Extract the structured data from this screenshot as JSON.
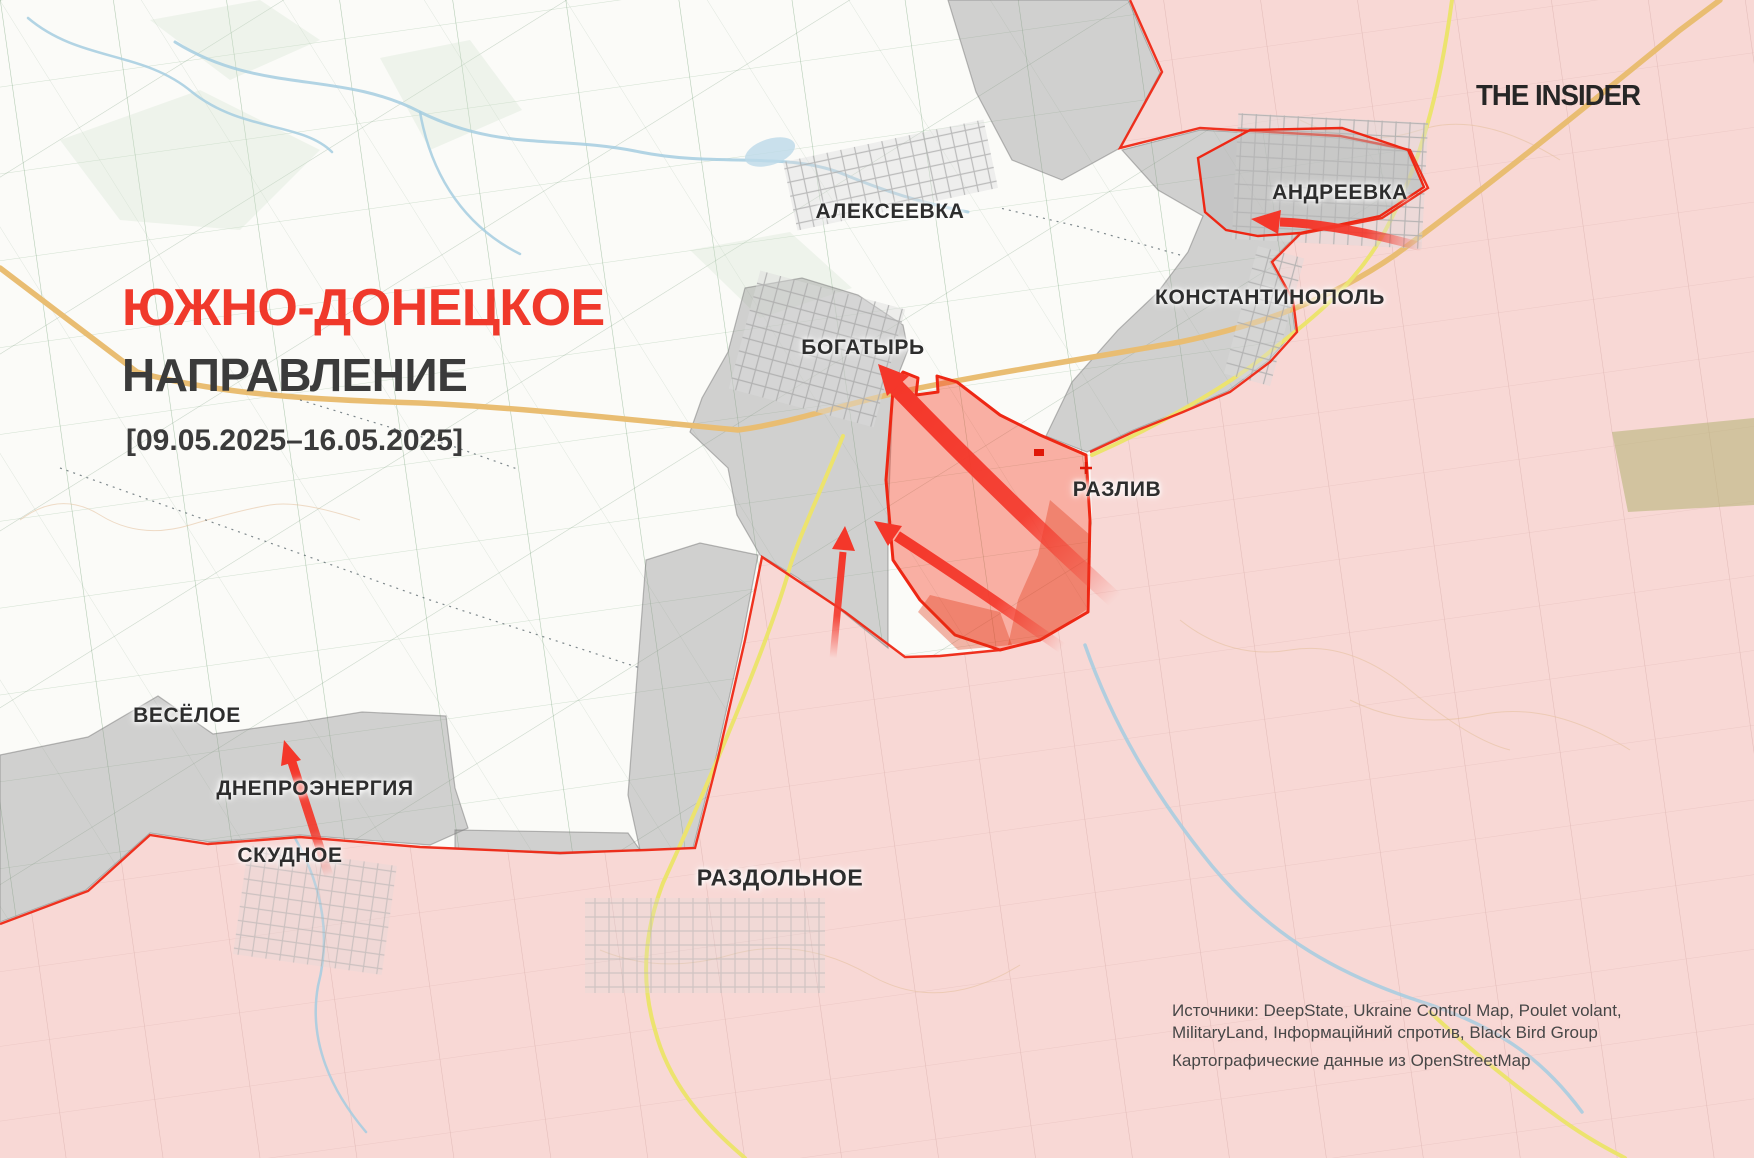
{
  "header": {
    "title_line1": "ЮЖНО-ДОНЕЦКОЕ",
    "title_line2": "НАПРАВЛЕНИЕ",
    "date_range": "[09.05.2025–16.05.2025]",
    "logo": "THE INSIDER"
  },
  "sources": {
    "line1": "Источники: DeepState, Ukraine Control Map, Poulet volant,",
    "line2": "MilitaryLand, Інформаційний спротив, Black Bird Group",
    "line3": "Картографические данные из OpenStreetMap"
  },
  "colors": {
    "title_red": "#f0392b",
    "arrow_red": "#f4372a",
    "advance_fill": "rgba(246,68,45,0.42)",
    "advance_stroke": "#ee2714",
    "occupied_pink": "#f8d8d5",
    "contested_gray": "rgba(145,145,145,0.40)",
    "road_orange": "#e9bd72",
    "road_yellow": "#ece36e",
    "river_blue": "#a5cde0",
    "field_green": "#6f9e72",
    "field_pink_line": "#d9aeaa",
    "contour_tan": "#e4c09b",
    "label_dark": "#2d2d2d"
  },
  "labels": [
    {
      "id": "alekseevka",
      "text": "АЛЕКСЕЕВКА",
      "x": 890,
      "y": 212
    },
    {
      "id": "andreevka",
      "text": "АНДРЕЕВКА",
      "x": 1340,
      "y": 193
    },
    {
      "id": "konstantinopol",
      "text": "КОНСТАНТИНОПОЛЬ",
      "x": 1270,
      "y": 298
    },
    {
      "id": "bogatyr",
      "text": "БОГАТЫРЬ",
      "x": 863,
      "y": 348
    },
    {
      "id": "razliv",
      "text": "РАЗЛИВ",
      "x": 1117,
      "y": 490
    },
    {
      "id": "vesyoloe",
      "text": "ВЕСЁЛОЕ",
      "x": 187,
      "y": 716
    },
    {
      "id": "dneproenergia",
      "text": "ДНЕПРОЭНЕРГИЯ",
      "x": 315,
      "y": 789
    },
    {
      "id": "skudnoe",
      "text": "СКУДНОЕ",
      "x": 290,
      "y": 856
    },
    {
      "id": "razdolnoe",
      "text": "РАЗДОЛЬНОЕ",
      "x": 780,
      "y": 878,
      "size": 23
    }
  ],
  "map": {
    "width": 1754,
    "height": 1158,
    "occupied_polygon": "1130,0 1754,0 1754,1158 0,1158 0,924 88,891 150,835 208,844 300,837 420,847 560,853 646,850 695,848 718,758 745,640 762,557 845,612 905,657 1000,650 1040,640 1089,612 1092,520 1090,452 1133,432 1183,412 1230,392 1270,362 1297,332 1293,300 1272,262 1300,234 1382,218 1428,188 1410,150 1340,136 1200,128 1120,148 1162,72",
    "frontline": "1130,0 1162,72 1120,148 1200,128 1340,136 1410,150 1428,188 1382,218 1300,234 1272,262 1293,300 1297,332 1270,362 1230,392 1183,412 1133,432 1090,452",
    "frontline_south": "1000,650 940,656 905,657 845,612 762,557 745,640 718,758 695,848 646,850 560,853 420,847 300,837 208,844 150,835 88,891 0,924",
    "gray_zones": [
      "948,0 1128,0 1160,73 1120,148 1062,180 1012,160 976,92",
      "1122,150 1200,130 1340,138 1406,150 1424,187 1380,217 1298,234 1270,262 1291,300 1295,331 1268,361 1228,391 1181,411 1131,431 1087,452 1046,436 1072,382 1118,330 1158,292 1188,252 1203,216 1158,190",
      "745,288 802,278 858,295 903,325 908,350 893,388 888,520 888,648 838,608 798,578 760,555 737,515 728,468 690,432 702,398 728,352",
      "0,755 88,737 158,696 213,734 300,722 362,712 446,716 455,788 468,828 430,845 300,835 210,842 150,833 86,890 0,922",
      "646,560 700,543 758,555 742,640 716,757 693,848 640,850 628,795 636,690",
      "455,830 628,833 640,850 560,854 455,848"
    ],
    "pocket_polygon": "1205,212 1198,158 1250,130 1342,128 1408,150 1424,187 1380,216 1300,233 1258,236 1226,230",
    "advance_polygon": "893,390 903,372 918,378 916,395 938,392 937,376 957,382 1000,415 1040,435 1086,455 1090,520 1088,612 1040,640 1000,650 955,635 920,600 893,560 886,480",
    "advance_inner": [
      "1050,500 1090,535 1086,610 1042,640 1008,645 1018,600 1038,555",
      "930,595 1000,612 1012,645 958,650 918,612"
    ],
    "green_patches": [
      "60,140 200,90 320,150 240,230 120,220",
      "380,58 470,40 522,110 430,150",
      "150,20 260,0 320,40 230,80",
      "690,250 790,232 852,288 760,318"
    ],
    "olive_patch": "1612,432 1754,418 1754,505 1628,512",
    "roads": [
      {
        "d": "M 0,268 L 137,372 C 220,395 320,400 420,403 C 530,408 650,422 738,430 C 790,423 830,408 900,392 C 980,375 1090,358 1180,342 C 1260,325 1330,300 1395,255 C 1470,200 1570,120 1680,30 L 1720,0",
        "color": "#e9bd72",
        "w": 5.5
      },
      {
        "d": "M 1452,0 C 1440,90 1420,170 1380,240 C 1350,290 1310,320 1272,350 C 1230,385 1160,425 1092,455",
        "color": "#ece36e",
        "w": 4
      },
      {
        "d": "M 843,436 C 815,505 795,545 787,577 C 765,650 710,780 663,883 C 645,930 640,980 655,1030 C 668,1080 700,1120 745,1158",
        "color": "#ece36e",
        "w": 4
      },
      {
        "d": "M 1430,1012 C 1470,1050 1520,1090 1562,1120 C 1590,1140 1610,1150 1625,1158",
        "color": "#ece36e",
        "w": 4
      }
    ],
    "rivers": [
      {
        "d": "M 175,42 C 260,95 340,70 420,112 C 500,152 560,135 640,152 C 720,168 790,150 848,176 C 902,198 938,206 968,212",
        "w": 3
      },
      {
        "d": "M 420,112 C 432,180 468,228 520,254",
        "w": 2.5
      },
      {
        "d": "M 1085,645 C 1112,722 1152,792 1212,866 C 1272,938 1342,976 1422,1002 C 1502,1028 1545,1062 1582,1112",
        "w": 3.5
      },
      {
        "d": "M 295,838 C 320,882 332,932 318,986 C 308,1042 332,1092 366,1132",
        "w": 2.5
      },
      {
        "d": "M 28,18 C 80,62 142,50 192,92 C 242,132 302,122 332,152",
        "w": 2.5
      }
    ],
    "contours": [
      "M 20,520 q 40,-30 80,-5 t 90,10 t 80,-20 t 90,15",
      "M 1180,620 q 50,40 110,30 t 120,40 t 100,60",
      "M 1300,120 q 60,30 120,10 t 140,30",
      "M 600,950 q 60,25 130,5 t 140,20 t 150,-10",
      "M 1350,700 q 60,30 130,15 t 150,35"
    ],
    "dashed_paths": [
      "M 60,468 L 430,600 L 640,668",
      "M 300,400 L 455,447 L 520,470",
      "M 1180,255 L 1085,228 L 1000,208"
    ],
    "urban_areas": [
      {
        "x": 788,
        "y": 140,
        "w": 205,
        "h": 70,
        "rot": -12,
        "op": 0.8
      },
      {
        "x": 742,
        "y": 288,
        "w": 150,
        "h": 122,
        "rot": 15,
        "op": 0.9
      },
      {
        "x": 1235,
        "y": 118,
        "w": 190,
        "h": 126,
        "rot": 3,
        "op": 0.85
      },
      {
        "x": 1240,
        "y": 250,
        "w": 48,
        "h": 132,
        "rot": 15,
        "op": 0.85
      },
      {
        "x": 585,
        "y": 898,
        "w": 240,
        "h": 95,
        "rot": 0,
        "op": 0.5
      },
      {
        "x": 240,
        "y": 855,
        "w": 150,
        "h": 110,
        "rot": 8,
        "op": 0.55
      }
    ],
    "arrows": [
      {
        "id": "arrow-bogatyr-main",
        "d": "M 1115,600 Q 1000,495 895,386",
        "w": 17,
        "tail": [
          1115,
          600
        ],
        "tip": [
          895,
          386
        ],
        "head": "878,364 909,376 887,396"
      },
      {
        "id": "arrow-razliv-mid",
        "d": "M 1062,648 Q 968,582 897,536",
        "w": 11,
        "tail": [
          1062,
          648
        ],
        "tip": [
          897,
          536
        ],
        "head": "874,521 902,526 888,546"
      },
      {
        "id": "arrow-center-vert",
        "d": "M 833,658 L 843,552",
        "w": 7,
        "tail": [
          833,
          658
        ],
        "tip": [
          843,
          552
        ],
        "head": "845,526 855,551 832,549"
      },
      {
        "id": "arrow-andreevka",
        "d": "M 1422,247 Q 1338,224 1280,222",
        "w": 9,
        "tail": [
          1422,
          247
        ],
        "tip": [
          1280,
          222
        ],
        "head": "1251,219 1281,210 1278,234"
      },
      {
        "id": "arrow-skudnoe",
        "d": "M 329,876 L 292,762",
        "w": 9,
        "tail": [
          329,
          876
        ],
        "tip": [
          292,
          762
        ],
        "head": "284,740 301,760 281,766"
      }
    ],
    "markers": {
      "red_cross": {
        "x": 1086,
        "y": 468
      },
      "red_square": {
        "x": 1034,
        "y": 449,
        "w": 10,
        "h": 7
      }
    }
  }
}
